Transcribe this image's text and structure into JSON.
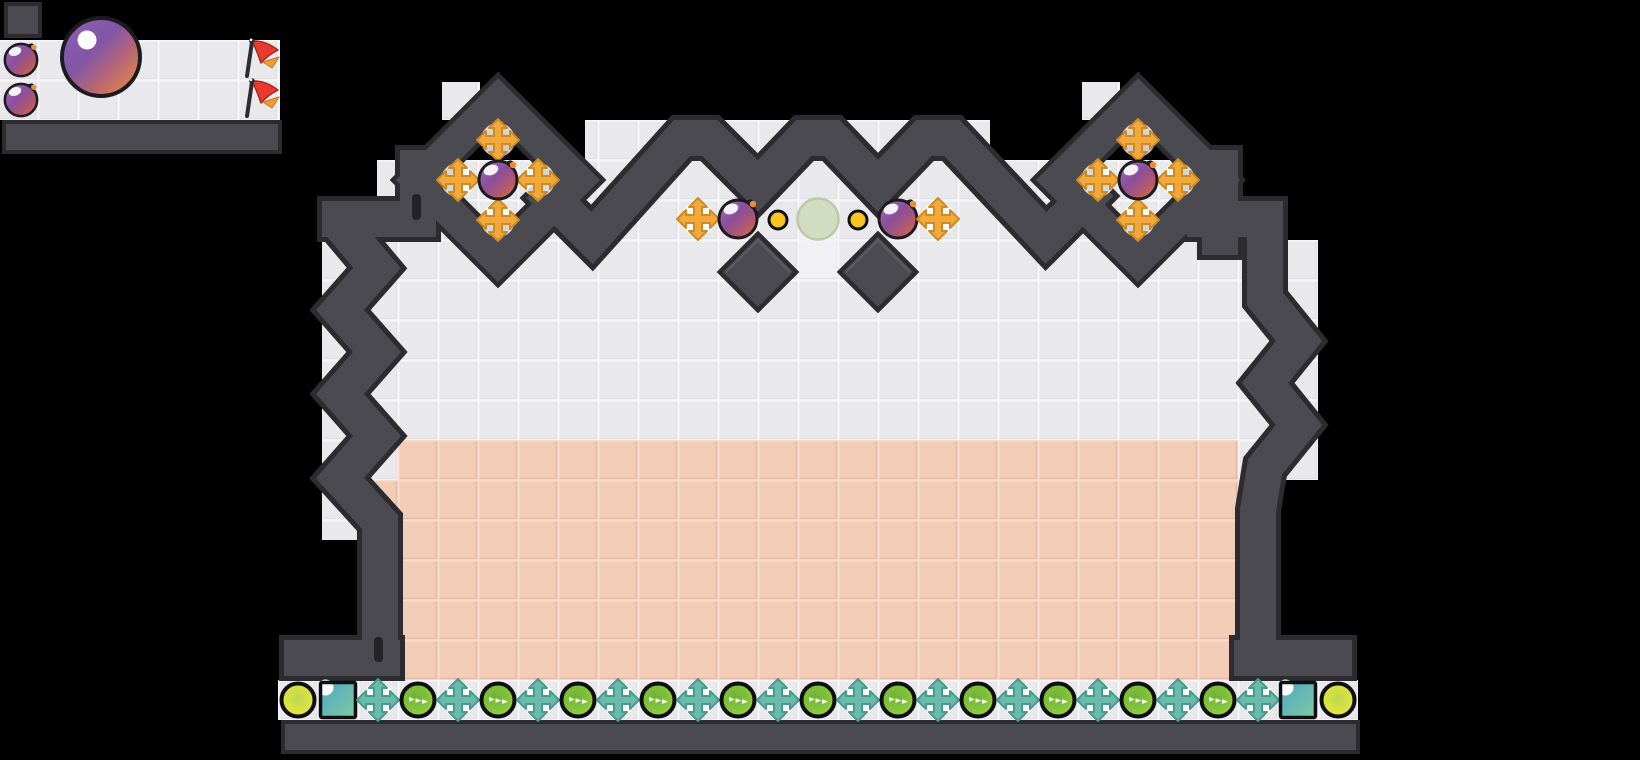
{
  "scene": {
    "width": 1640,
    "height": 760,
    "background": "#000000"
  },
  "palette": {
    "wall": "#4a4a50",
    "wall_outline": "#2b2b30",
    "wall_bevel": "#5b5b62",
    "latch": "#222227",
    "tile": "#e9e9ec",
    "tile_line": "#f6f6f8",
    "tile_shade": "#dfdfe3",
    "pink": "#f2ccb6",
    "pink_line": "#f8ddcd",
    "pink_shade": "#e4b9a2",
    "badge": "#ffffff",
    "cross_orange": "#f2a93c",
    "cross_orange_edge": "#cf8a22",
    "cross_teal": "#69bbac",
    "cross_teal_edge": "#4a9a8b",
    "plum_outline": "#1c1c20",
    "plum_grad": [
      "#a86fb6",
      "#8b4f9e",
      "#b4586a",
      "#dd7f3f"
    ],
    "stem_dot": "#ee8f2f",
    "ball_grad": [
      "#8f60b2",
      "#8255a8",
      "#c06b6b",
      "#ee9340"
    ],
    "dot_yellow": "#f6c51e",
    "dot_yellow_edge": "#101014",
    "pale_circle": "#d2dcc1",
    "pale_circle_edge": "#bcc8a8",
    "flag_red": "#e93a2e",
    "flag_red_edge": "#9c2a1c",
    "flag_orange": "#f59a31",
    "flag_orange_edge": "#c07a1c",
    "flag_pole": "#2b2b30",
    "ring_black": "#0f0f11",
    "tray_green_grad": [
      "#6ab534",
      "#8ac63c",
      "#d8e84a"
    ],
    "tray_yellow_grad": [
      "#bdd64d",
      "#ebeb3a"
    ],
    "square_grad": [
      "#4ea5c8",
      "#7ecb9d"
    ],
    "bottom_bar": "#4a4a50"
  },
  "minimap": {
    "items": [
      {
        "type": "plum",
        "x": 21,
        "y": 60,
        "scale": 0.85
      },
      {
        "type": "plum",
        "x": 21,
        "y": 100,
        "scale": 0.85
      },
      {
        "type": "ball",
        "x": 101,
        "y": 57,
        "scale": 1
      },
      {
        "type": "flag",
        "x": 259,
        "y": 59,
        "scale": 1
      },
      {
        "type": "flag",
        "x": 259,
        "y": 99,
        "scale": 1
      }
    ]
  },
  "level": {
    "turrets": [
      {
        "cx": 498,
        "cy": 180,
        "outer": 102,
        "inner": 58
      },
      {
        "cx": 1138,
        "cy": 180,
        "outer": 102,
        "inner": 58
      }
    ],
    "diamonds": [
      {
        "x": 758,
        "y": 272,
        "half": 35
      },
      {
        "x": 878,
        "y": 272,
        "half": 35
      }
    ],
    "items": [
      {
        "type": "cross",
        "x": 498,
        "y": 140
      },
      {
        "type": "cross",
        "x": 458,
        "y": 180
      },
      {
        "type": "cross",
        "x": 538,
        "y": 180
      },
      {
        "type": "cross",
        "x": 498,
        "y": 220
      },
      {
        "type": "plum",
        "x": 498,
        "y": 180
      },
      {
        "type": "cross",
        "x": 1138,
        "y": 140
      },
      {
        "type": "cross",
        "x": 1098,
        "y": 180
      },
      {
        "type": "cross",
        "x": 1178,
        "y": 180
      },
      {
        "type": "cross",
        "x": 1138,
        "y": 220
      },
      {
        "type": "plum",
        "x": 1138,
        "y": 180
      },
      {
        "type": "cross",
        "x": 698,
        "y": 219
      },
      {
        "type": "plum",
        "x": 738,
        "y": 219
      },
      {
        "type": "dot",
        "x": 778,
        "y": 220
      },
      {
        "type": "pale",
        "x": 818,
        "y": 219
      },
      {
        "type": "dot",
        "x": 858,
        "y": 220
      },
      {
        "type": "plum",
        "x": 898,
        "y": 219
      },
      {
        "type": "cross",
        "x": 938,
        "y": 219
      }
    ]
  },
  "tray": {
    "y": 700,
    "start_x": 298,
    "step": 40,
    "sequence": [
      "yellow",
      "square",
      "cross",
      "green",
      "cross",
      "green",
      "cross",
      "green",
      "cross",
      "green",
      "cross",
      "green",
      "cross",
      "green",
      "cross",
      "green",
      "cross",
      "green",
      "cross",
      "green",
      "cross",
      "green",
      "cross",
      "green",
      "cross",
      "square",
      "yellow"
    ]
  }
}
